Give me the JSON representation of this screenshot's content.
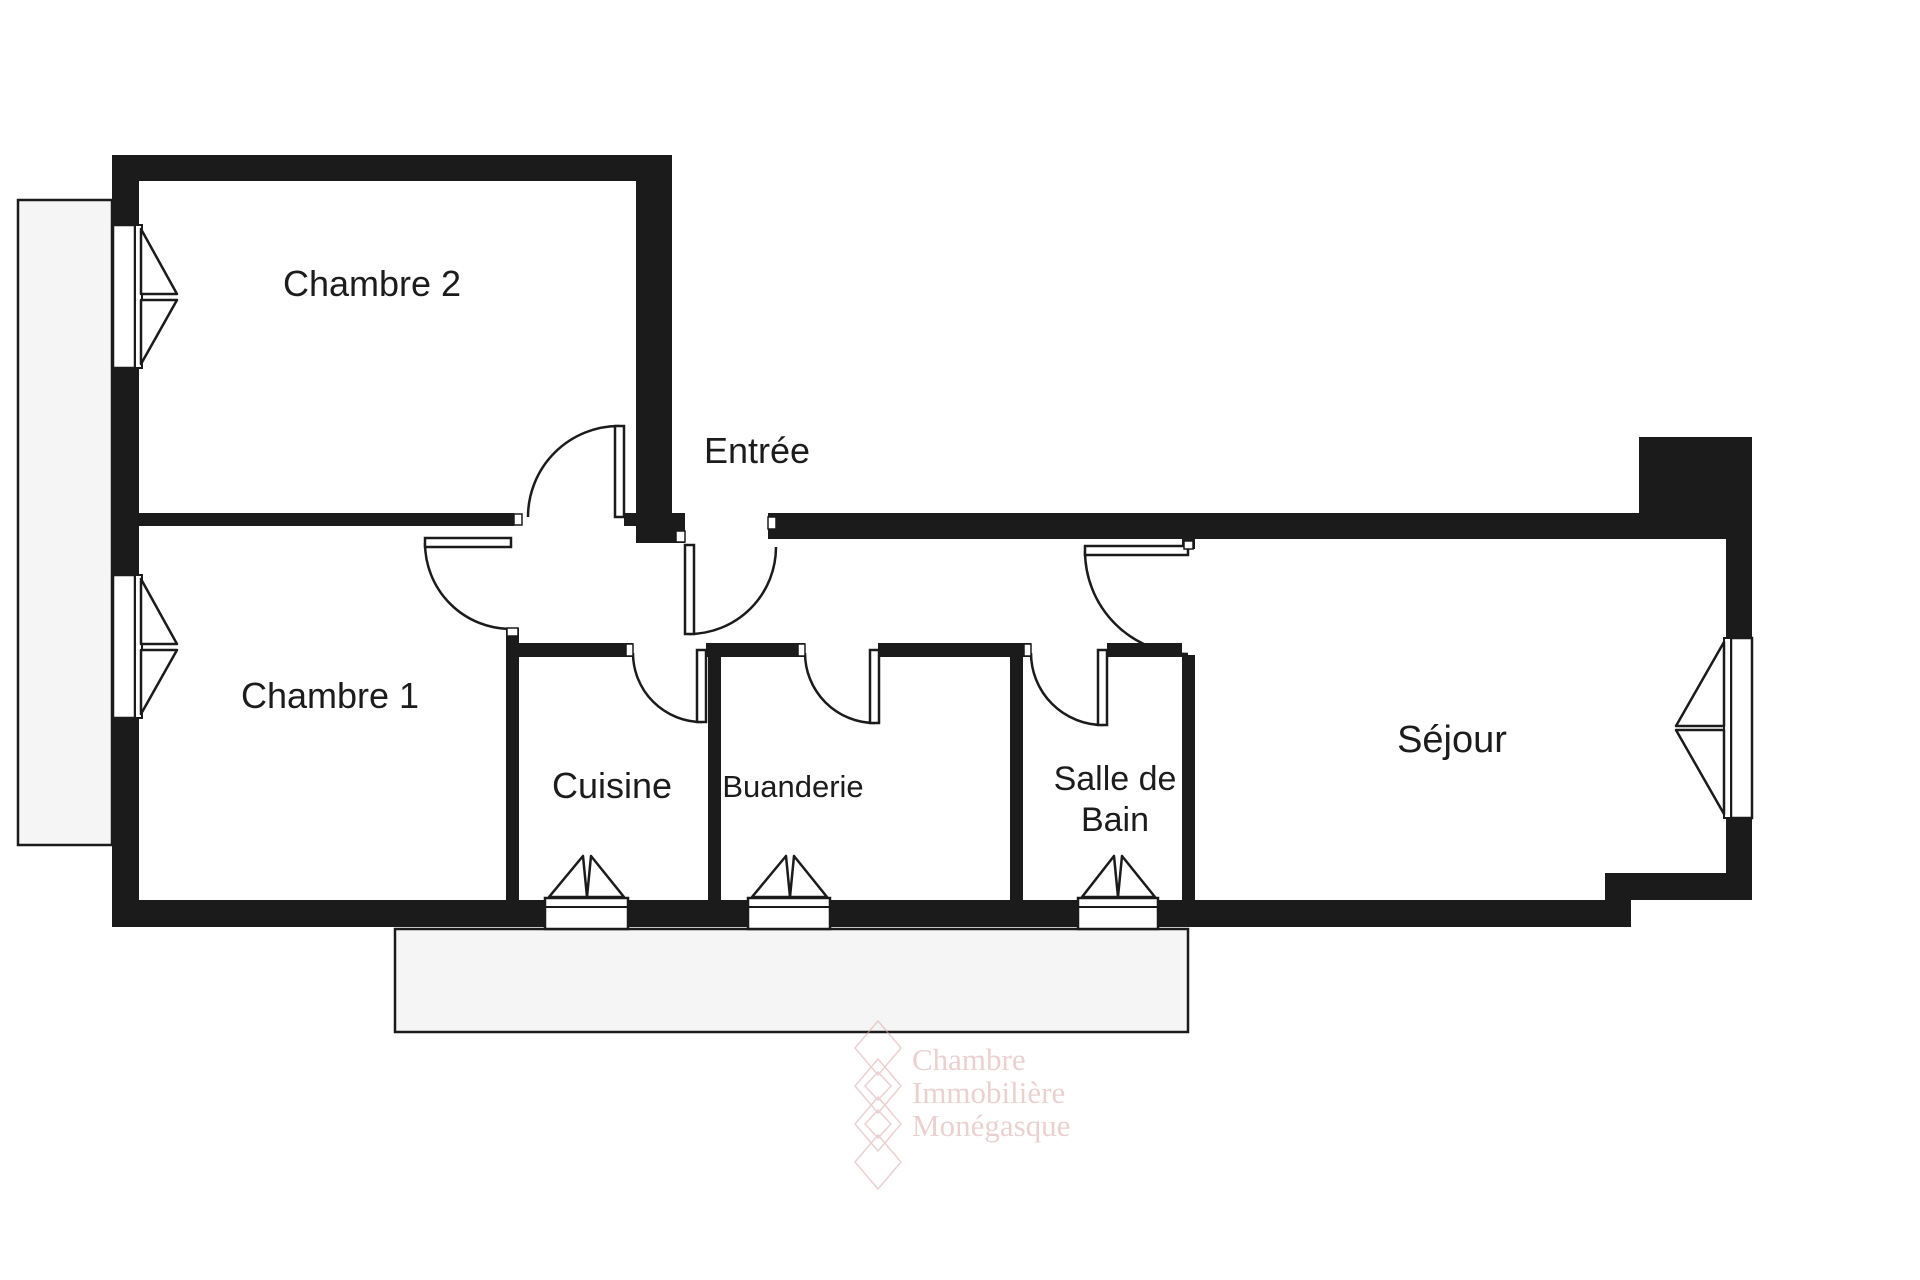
{
  "colors": {
    "wall": "#1b1b1b",
    "label": "#1c1c1c",
    "outdoor_fill": "#f5f5f5",
    "outdoor_border": "#1b1b1b",
    "watermark": "#dcaaaa"
  },
  "rooms": [
    {
      "id": "chambre-2",
      "label": "Chambre 2"
    },
    {
      "id": "entree",
      "label": "Entrée"
    },
    {
      "id": "chambre-1",
      "label": "Chambre 1"
    },
    {
      "id": "cuisine",
      "label": "Cuisine"
    },
    {
      "id": "buanderie",
      "label": "Buanderie"
    },
    {
      "id": "salle-de-bain",
      "label": "Salle de Bain",
      "lines": [
        "Salle de",
        "Bain"
      ]
    },
    {
      "id": "sejour",
      "label": "Séjour"
    }
  ],
  "watermark": {
    "lines": [
      "Chambre",
      "Immobilière",
      "Monégasque"
    ]
  }
}
